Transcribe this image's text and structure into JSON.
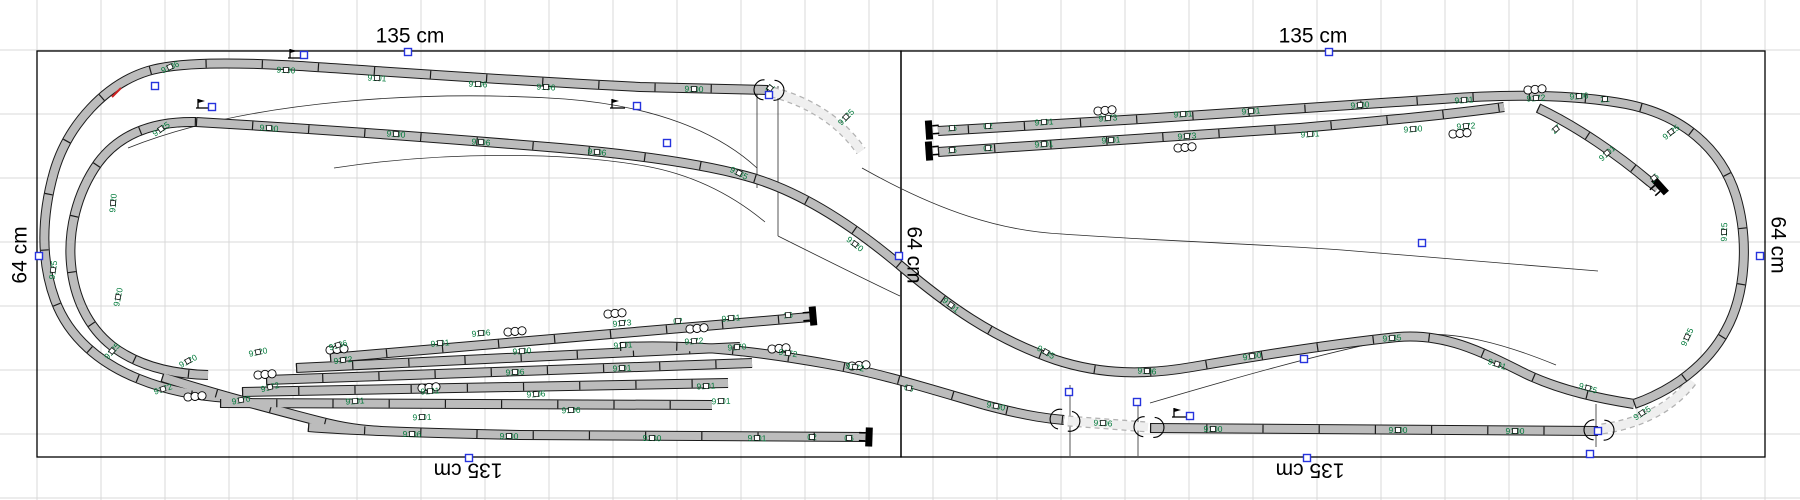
{
  "app": {
    "canvas_kind": "track-plan-editor"
  },
  "colors": {
    "grid": "#d8d8d8",
    "board_outline": "#000000",
    "track_fill": "#bcbcbc",
    "track_outline": "#1a1a1a",
    "ghost_fill": "#efefef",
    "ghost_outline": "#b2b2b2",
    "label_green": "#007a3a",
    "handle_blue": "#2633dd",
    "buffer_black": "#000000",
    "thin_line": "#2a2a2a",
    "red_mark": "#cc2222"
  },
  "grid": {
    "spacing": 64,
    "offset_x": 37,
    "offset_y": 50
  },
  "boards": [
    {
      "x": 37,
      "y": 51,
      "w": 864,
      "h": 406
    },
    {
      "x": 901,
      "y": 51,
      "w": 864,
      "h": 406
    }
  ],
  "dimension_labels": [
    {
      "t": "135 cm",
      "x": 410,
      "y": 36,
      "r": 0
    },
    {
      "t": "135 cm",
      "x": 1313,
      "y": 36,
      "r": 0
    },
    {
      "t": "135 cm",
      "x": 468,
      "y": 470,
      "r": 180
    },
    {
      "t": "135 cm",
      "x": 1310,
      "y": 470,
      "r": 180
    },
    {
      "t": "64 cm",
      "x": 20,
      "y": 255,
      "r": -90
    },
    {
      "t": "64 cm",
      "x": 914,
      "y": 255,
      "r": 90
    },
    {
      "t": "64 cm",
      "x": 1778,
      "y": 245,
      "r": 90
    }
  ],
  "tracks_solid": [
    "M768,90 L640,87 C500,80 380,71 300,66 C232,62 178,62 148,71 C106,84 68,124 54,172 C41,218 41,262 55,300 C69,338 101,364 139,379 C166,390 196,396 228,398",
    "M162,377 C215,394 268,408 318,421 C345,428 362,430 382,431",
    "M330,358 L810,317",
    "M296,368 L740,347",
    "M620,347 C700,344 760,352 828,364 C880,373 930,389 985,405 C1030,417 1052,419 1064,420",
    "M266,380 L752,363",
    "M242,392 L728,383",
    "M220,403 L712,405",
    "M308,427 C360,431 430,433 520,435 L869,437",
    "M196,122 C150,121 118,136 98,163 C76,194 68,232 71,264 C74,298 88,327 112,346 C138,366 172,374 208,375",
    "M196,122 C300,128 440,138 560,148 C640,155 702,164 746,176 C802,191 856,228 902,267 C946,304 992,338 1056,360 C1102,375 1146,375 1192,367 C1262,355 1332,344 1398,337 C1446,333 1482,352 1526,374 C1562,391 1602,399 1634,404",
    "M1634,404 C1674,390 1708,364 1726,330 C1746,294 1749,240 1736,196 C1721,148 1682,115 1626,104 C1572,94 1502,94 1442,99 C1320,108 1100,122 938,131",
    "M938,152 L1300,128 C1380,121 1446,115 1504,107",
    "M1538,108 C1578,127 1618,155 1650,182 L1658,188",
    "M1150,428 L1598,431"
  ],
  "tracks_ghost": [
    "M772,92 C814,103 843,125 861,151",
    "M1068,421 L1148,427",
    "M1602,429 C1644,423 1674,405 1692,381"
  ],
  "thin_lines": [
    "M128,148 C250,99 430,90 565,99 C655,106 718,132 757,168",
    "M334,168 C445,151 565,152 645,166 C695,175 735,197 765,222",
    "M757,86 L757,188",
    "M778,86 L778,236",
    "M862,168 C940,212 1002,231 1062,234 C1162,241 1258,244 1342,250 C1432,258 1522,264 1598,271",
    "M1150,403 C1235,378 1315,355 1402,337 C1452,327 1512,347 1556,365",
    "M1070,385 L1070,456",
    "M1138,400 L1138,456",
    "M1596,404 L1596,447",
    "M778,236 C830,262 870,282 900,296"
  ],
  "red_mark_path": "M112,97 L121,88",
  "part_labels": [
    {
      "t": "9136",
      "x": 170,
      "y": 67,
      "r": -24
    },
    {
      "t": "9100",
      "x": 286,
      "y": 70,
      "r": 3
    },
    {
      "t": "9101",
      "x": 377,
      "y": 78,
      "r": 3
    },
    {
      "t": "9106",
      "x": 478,
      "y": 84,
      "r": 3
    },
    {
      "t": "9106",
      "x": 546,
      "y": 87,
      "r": 3
    },
    {
      "t": "9100",
      "x": 694,
      "y": 89,
      "r": 2
    },
    {
      "t": "9125",
      "x": 161,
      "y": 129,
      "r": -35
    },
    {
      "t": "9100",
      "x": 269,
      "y": 128,
      "r": 4
    },
    {
      "t": "9100",
      "x": 396,
      "y": 134,
      "r": 4
    },
    {
      "t": "9106",
      "x": 481,
      "y": 142,
      "r": 4
    },
    {
      "t": "9106",
      "x": 597,
      "y": 152,
      "r": 5
    },
    {
      "t": "9135",
      "x": 739,
      "y": 173,
      "r": 27
    },
    {
      "t": "9120",
      "x": 855,
      "y": 244,
      "r": 38
    },
    {
      "t": "9101",
      "x": 951,
      "y": 305,
      "r": 39
    },
    {
      "t": "9135",
      "x": 1046,
      "y": 352,
      "r": 30
    },
    {
      "t": "9106",
      "x": 1147,
      "y": 371,
      "r": 3
    },
    {
      "t": "9100",
      "x": 1252,
      "y": 356,
      "r": -9
    },
    {
      "t": "9135",
      "x": 1392,
      "y": 338,
      "r": -4
    },
    {
      "t": "9101",
      "x": 1497,
      "y": 364,
      "r": 19
    },
    {
      "t": "9125",
      "x": 1588,
      "y": 388,
      "r": 17
    },
    {
      "t": "9125",
      "x": 1687,
      "y": 337,
      "r": -65
    },
    {
      "t": "9125",
      "x": 1724,
      "y": 232,
      "r": -88
    },
    {
      "t": "9125",
      "x": 1671,
      "y": 132,
      "r": -38
    },
    {
      "t": "16",
      "x": 952,
      "y": 128,
      "r": -4
    },
    {
      "t": "02",
      "x": 988,
      "y": 126,
      "r": -4
    },
    {
      "t": "9101",
      "x": 1044,
      "y": 122,
      "r": -4
    },
    {
      "t": "9173",
      "x": 1108,
      "y": 118,
      "r": -4
    },
    {
      "t": "9101",
      "x": 1183,
      "y": 114,
      "r": -4
    },
    {
      "t": "9101",
      "x": 1251,
      "y": 111,
      "r": -4
    },
    {
      "t": "9100",
      "x": 1360,
      "y": 105,
      "r": -4
    },
    {
      "t": "9101",
      "x": 1464,
      "y": 100,
      "r": -4
    },
    {
      "t": "9172",
      "x": 1536,
      "y": 98,
      "r": -4
    },
    {
      "t": "9106",
      "x": 1579,
      "y": 96,
      "r": -4
    },
    {
      "t": "21",
      "x": 1605,
      "y": 99,
      "r": -4
    },
    {
      "t": "16",
      "x": 952,
      "y": 150,
      "r": -4
    },
    {
      "t": "02",
      "x": 988,
      "y": 148,
      "r": -4
    },
    {
      "t": "9101",
      "x": 1044,
      "y": 144,
      "r": -4
    },
    {
      "t": "9101",
      "x": 1111,
      "y": 140,
      "r": -4
    },
    {
      "t": "9173",
      "x": 1187,
      "y": 136,
      "r": -4
    },
    {
      "t": "9101",
      "x": 1310,
      "y": 134,
      "r": -4
    },
    {
      "t": "9100",
      "x": 1413,
      "y": 129,
      "r": -4
    },
    {
      "t": "9172",
      "x": 1466,
      "y": 126,
      "r": -4
    },
    {
      "t": "27",
      "x": 1556,
      "y": 129,
      "r": -42
    },
    {
      "t": "9101",
      "x": 1607,
      "y": 153,
      "r": -42
    },
    {
      "t": "16",
      "x": 1654,
      "y": 178,
      "r": -42
    },
    {
      "t": "9125",
      "x": 53,
      "y": 270,
      "r": -82
    },
    {
      "t": "9125",
      "x": 112,
      "y": 351,
      "r": -48
    },
    {
      "t": "9120",
      "x": 113,
      "y": 203,
      "r": -85
    },
    {
      "t": "9120",
      "x": 118,
      "y": 297,
      "r": -78
    },
    {
      "t": "9120",
      "x": 188,
      "y": 361,
      "r": -28
    },
    {
      "t": "9120",
      "x": 258,
      "y": 352,
      "r": -12
    },
    {
      "t": "9136",
      "x": 338,
      "y": 345,
      "r": -16
    },
    {
      "t": "9172",
      "x": 343,
      "y": 360,
      "r": -7
    },
    {
      "t": "9106",
      "x": 481,
      "y": 333,
      "r": -5
    },
    {
      "t": "9173",
      "x": 622,
      "y": 323,
      "r": -5
    },
    {
      "t": "02",
      "x": 678,
      "y": 321,
      "r": -5
    },
    {
      "t": "9101",
      "x": 731,
      "y": 318,
      "r": -5
    },
    {
      "t": "16",
      "x": 788,
      "y": 315,
      "r": -5
    },
    {
      "t": "9101",
      "x": 440,
      "y": 343,
      "r": -5
    },
    {
      "t": "9100",
      "x": 522,
      "y": 351,
      "r": -4
    },
    {
      "t": "9101",
      "x": 623,
      "y": 345,
      "r": -4
    },
    {
      "t": "9172",
      "x": 694,
      "y": 341,
      "r": -4
    },
    {
      "t": "9170",
      "x": 737,
      "y": 347,
      "r": -4
    },
    {
      "t": "9106",
      "x": 515,
      "y": 372,
      "r": -3
    },
    {
      "t": "9101",
      "x": 622,
      "y": 368,
      "r": -3
    },
    {
      "t": "9172",
      "x": 788,
      "y": 353,
      "r": 8
    },
    {
      "t": "9172",
      "x": 855,
      "y": 367,
      "r": 10
    },
    {
      "t": "06",
      "x": 909,
      "y": 388,
      "r": 11
    },
    {
      "t": "9100",
      "x": 996,
      "y": 406,
      "r": 11
    },
    {
      "t": "9172",
      "x": 163,
      "y": 389,
      "r": -18
    },
    {
      "t": "9170",
      "x": 241,
      "y": 400,
      "r": -10
    },
    {
      "t": "9172",
      "x": 270,
      "y": 387,
      "r": -14
    },
    {
      "t": "9101",
      "x": 355,
      "y": 401,
      "r": -4
    },
    {
      "t": "9101",
      "x": 430,
      "y": 391,
      "r": -4
    },
    {
      "t": "9106",
      "x": 536,
      "y": 394,
      "r": -4
    },
    {
      "t": "9101",
      "x": 706,
      "y": 386,
      "r": -3
    },
    {
      "t": "9101",
      "x": 422,
      "y": 417,
      "r": -2
    },
    {
      "t": "9106",
      "x": 571,
      "y": 410,
      "r": -2
    },
    {
      "t": "9101",
      "x": 721,
      "y": 401,
      "r": -2
    },
    {
      "t": "9106",
      "x": 412,
      "y": 434,
      "r": 1
    },
    {
      "t": "9100",
      "x": 509,
      "y": 436,
      "r": 1
    },
    {
      "t": "9100",
      "x": 652,
      "y": 438,
      "r": 1
    },
    {
      "t": "9101",
      "x": 757,
      "y": 438,
      "r": 1
    },
    {
      "t": "02",
      "x": 812,
      "y": 437,
      "r": 1
    },
    {
      "t": "06",
      "x": 849,
      "y": 438,
      "r": 1
    },
    {
      "t": "9100",
      "x": 1213,
      "y": 429,
      "r": 0
    },
    {
      "t": "9100",
      "x": 1398,
      "y": 430,
      "r": 0
    },
    {
      "t": "9100",
      "x": 1515,
      "y": 431,
      "r": 0
    },
    {
      "t": "9125",
      "x": 846,
      "y": 117,
      "r": -45
    },
    {
      "t": "21",
      "x": 770,
      "y": 88,
      "r": -50
    },
    {
      "t": "9106",
      "x": 1103,
      "y": 423,
      "r": 3
    },
    {
      "t": "9125",
      "x": 1642,
      "y": 413,
      "r": -33
    }
  ],
  "turnout_markers": [
    [
      188,
      397
    ],
    [
      258,
      375
    ],
    [
      330,
      350
    ],
    [
      422,
      388
    ],
    [
      508,
      332
    ],
    [
      608,
      314
    ],
    [
      690,
      329
    ],
    [
      772,
      349
    ],
    [
      852,
      366
    ],
    [
      1098,
      111
    ],
    [
      1178,
      148
    ],
    [
      1453,
      134
    ],
    [
      1528,
      90
    ]
  ],
  "buffers": [
    {
      "x": 813,
      "y": 316,
      "r": 175
    },
    {
      "x": 869,
      "y": 437,
      "r": 182
    },
    {
      "x": 929,
      "y": 130,
      "r": -4
    },
    {
      "x": 929,
      "y": 151,
      "r": -4
    },
    {
      "x": 1660,
      "y": 186,
      "r": 138
    }
  ],
  "open_ends": [
    {
      "x": 768,
      "y": 90,
      "r": 3
    },
    {
      "x": 1064,
      "y": 420,
      "r": 12
    },
    {
      "x": 1148,
      "y": 427,
      "r": 4
    },
    {
      "x": 1598,
      "y": 430,
      "r": 2
    }
  ],
  "signals": [
    {
      "x": 288,
      "y": 52
    },
    {
      "x": 196,
      "y": 102
    },
    {
      "x": 610,
      "y": 102
    },
    {
      "x": 1172,
      "y": 411
    }
  ],
  "handles": [
    [
      408,
      52
    ],
    [
      469,
      458
    ],
    [
      39,
      256
    ],
    [
      899,
      256
    ],
    [
      1329,
      52
    ],
    [
      1307,
      458
    ],
    [
      1760,
      256
    ],
    [
      769,
      95
    ],
    [
      155,
      86
    ],
    [
      667,
      143
    ],
    [
      1069,
      392
    ],
    [
      1137,
      402
    ],
    [
      1598,
      431
    ],
    [
      1590,
      454
    ],
    [
      1422,
      243
    ],
    [
      1304,
      359
    ],
    [
      304,
      55
    ],
    [
      637,
      106
    ],
    [
      1190,
      416
    ],
    [
      212,
      107
    ]
  ]
}
